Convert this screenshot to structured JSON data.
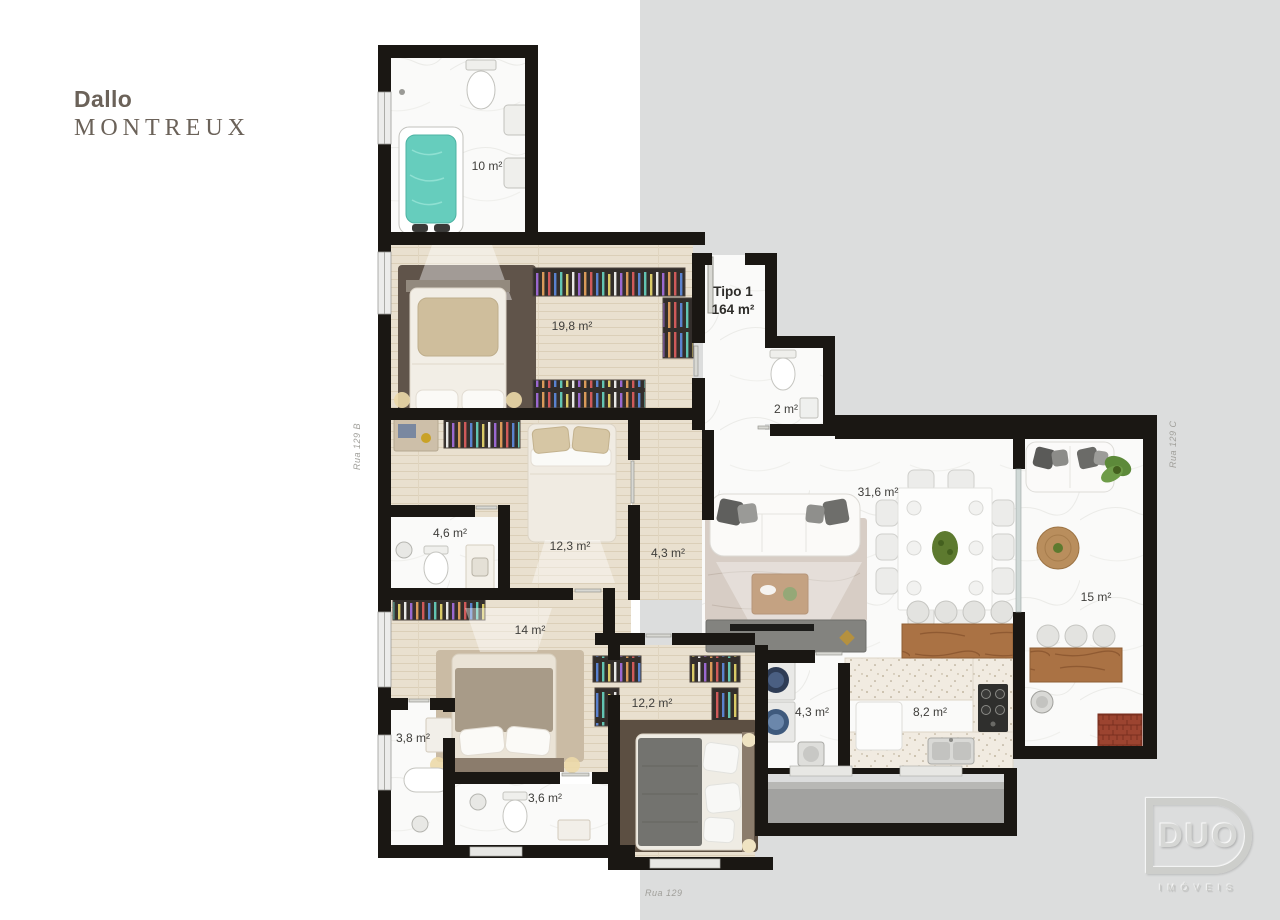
{
  "branding": {
    "name": "Dallo",
    "building": "MONTREUX"
  },
  "unit": {
    "type": "Tipo 1",
    "area": "164 m²"
  },
  "rooms": {
    "bath_master": "10 m²",
    "suite_master": "19,8 m²",
    "wc": "2 m²",
    "suite_2": "12,3 m²",
    "bath_2": "4,6 m²",
    "hall": "4,3 m²",
    "living": "31,6 m²",
    "terrace": "15 m²",
    "suite_3": "14 m²",
    "bath_3": "3,8 m²",
    "bath_4": "3,6 m²",
    "suite_4": "12,2 m²",
    "laundry": "4,3 m²",
    "kitchen": "8,2 m²"
  },
  "streets": {
    "left": "Rua 129 B",
    "right": "Rua 129 C",
    "bottom": "Rua 129"
  },
  "footer_logo": {
    "name": "DUO",
    "tagline": "IMÓVEIS"
  },
  "colors": {
    "wall": "#1a1713",
    "wood_floor": "#e8dfcd",
    "marble_floor": "#fafaf9",
    "water": "#66cdbd",
    "counter_wood": "#a9713f",
    "background_right": "#dcdddd"
  }
}
